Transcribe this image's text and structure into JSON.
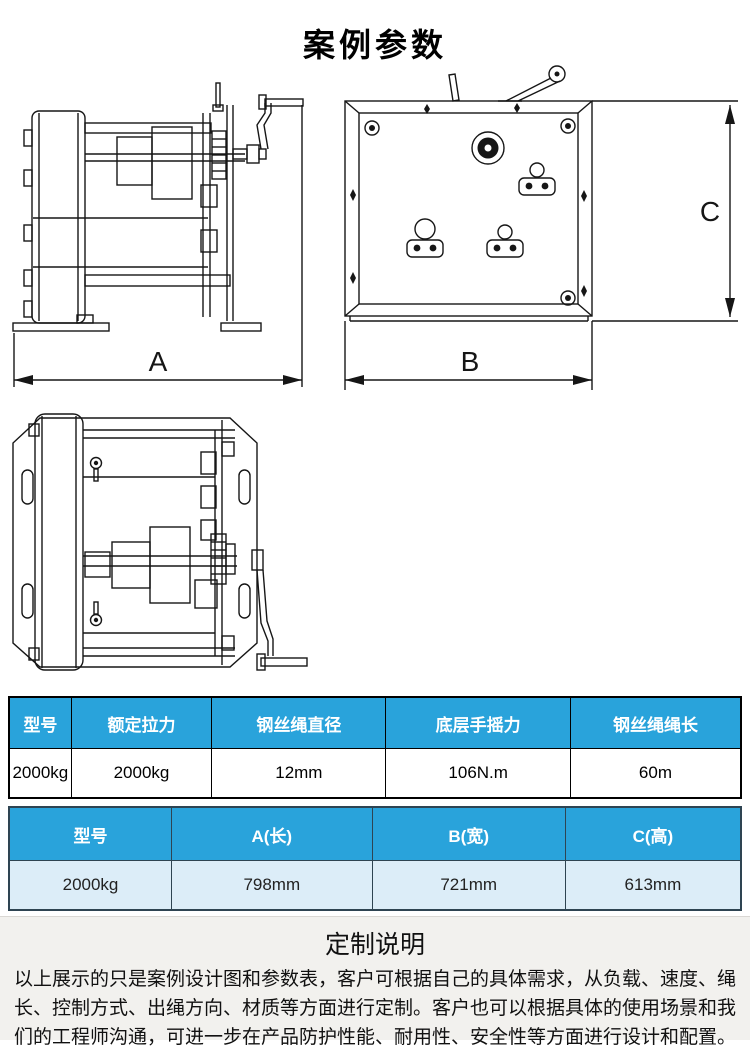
{
  "page": {
    "title": "案例参数"
  },
  "drawings": {
    "dim_a": "A",
    "dim_b": "B",
    "dim_c": "C",
    "side_view": "winch-side-view",
    "front_view": "winch-front-view",
    "top_view": "winch-top-view"
  },
  "spec_table": {
    "headers": [
      "型号",
      "额定拉力",
      "钢丝绳直径",
      "底层手摇力",
      "钢丝绳绳长"
    ],
    "row": [
      "2000kg",
      "2000kg",
      "12mm",
      "106N.m",
      "60m"
    ]
  },
  "dim_table": {
    "headers": [
      "型号",
      "A(长)",
      "B(宽)",
      "C(高)"
    ],
    "row": [
      "2000kg",
      "798mm",
      "721mm",
      "613mm"
    ]
  },
  "custom_note": {
    "title": "定制说明",
    "body": "以上展示的只是案例设计图和参数表，客户可根据自己的具体需求，从负载、速度、绳长、控制方式、出绳方向、材质等方面进行定制。客户也可以根据具体的使用场景和我们的工程师沟通，可进一步在产品防护性能、耐用性、安全性等方面进行设计和配置。"
  },
  "colors": {
    "header_blue": "#29A3DB",
    "light_blue_row": "#DCEDF8",
    "note_bg": "#F2F1EE",
    "line_color": "#161616"
  }
}
